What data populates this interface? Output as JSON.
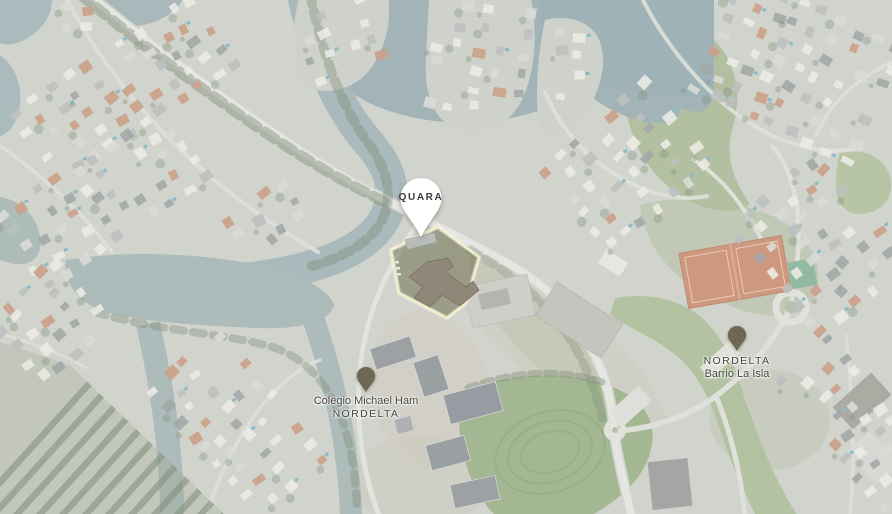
{
  "markers": {
    "quara": {
      "label": "QUARA",
      "icon": "balloon-pin-icon"
    },
    "colegio": {
      "line1": "Colegio Michael Ham",
      "line2": "NORDELTA",
      "icon": "map-pin-icon"
    },
    "barrio": {
      "line1": "NORDELTA",
      "line2": "Barrio La Isla",
      "icon": "map-pin-icon"
    }
  },
  "colors": {
    "balloon_fill": "#ffffff",
    "pin_fill": "#6e6853",
    "label_text": "#3c3c3c",
    "property_outline": "#f4efc6",
    "water": "#96a8aa",
    "land": "#c8cac2",
    "field_green": "#8da678",
    "tennis_court_orange": "#c57f5f"
  }
}
